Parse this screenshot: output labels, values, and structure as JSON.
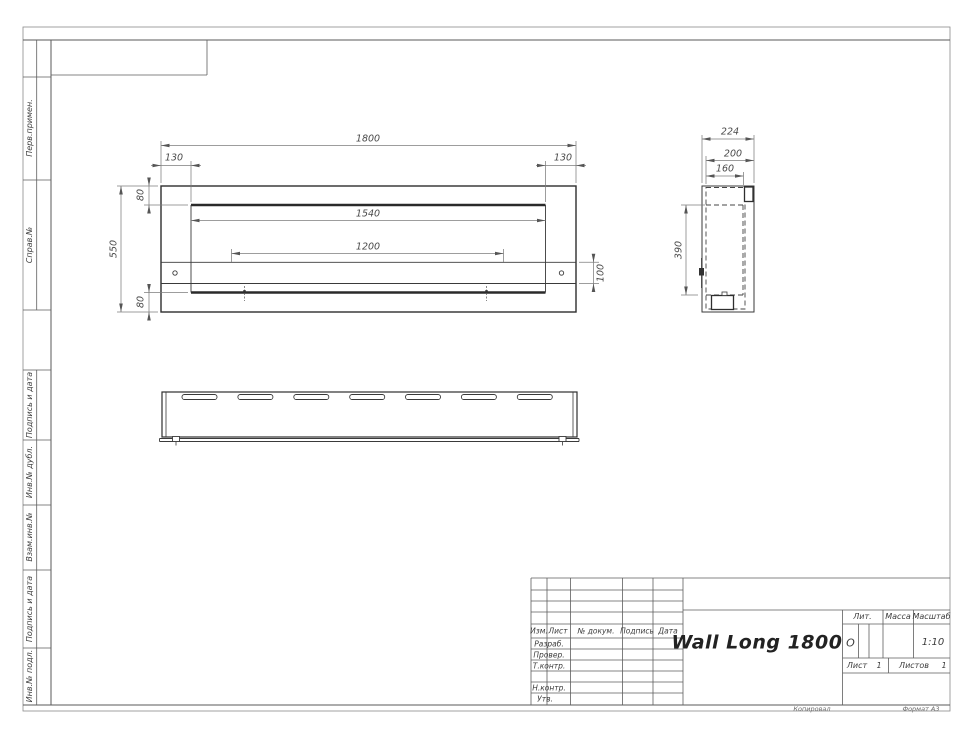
{
  "frame": {
    "margin_labels_top": [
      "Перв.примен.",
      "Справ.№"
    ],
    "margin_labels_bottom": [
      "Подпись и дата",
      "Инв.№ дубл.",
      "Взам.инв.№",
      "Подпись и дата",
      "Инв.№ подл."
    ],
    "footer": {
      "copied": "Копировал",
      "format": "Формат А3"
    }
  },
  "title_block": {
    "doc_title": "Wall Long 1800",
    "header_cols": {
      "izm": "Изм.",
      "list": "Лист",
      "doc_num": "№ докум.",
      "sign": "Подпись",
      "date": "Дата"
    },
    "staff_rows": {
      "developed": "Разраб.",
      "checked": "Провер.",
      "tcontrol": "Т.контр.",
      "ncontrol": "Н.контр.",
      "approved": "Утв."
    },
    "lit": {
      "label": "Лит.",
      "value": "О"
    },
    "mass": {
      "label": "Масса",
      "value": ""
    },
    "scale": {
      "label": "Масштаб",
      "value": "1:10"
    },
    "sheet": {
      "label": "Лист",
      "value": "1"
    },
    "sheets": {
      "label": "Листов",
      "value": "1"
    }
  },
  "dimensions": {
    "front": {
      "overall_width": "1800",
      "left_inset": "130",
      "right_inset": "130",
      "opening_width": "1540",
      "burner_length": "1200",
      "overall_height": "550",
      "top_inset": "80",
      "bottom_inset": "80",
      "shelf_height": "100"
    },
    "side": {
      "depth": "224",
      "body_depth": "200",
      "inner_depth": "160",
      "inner_height": "390"
    }
  }
}
